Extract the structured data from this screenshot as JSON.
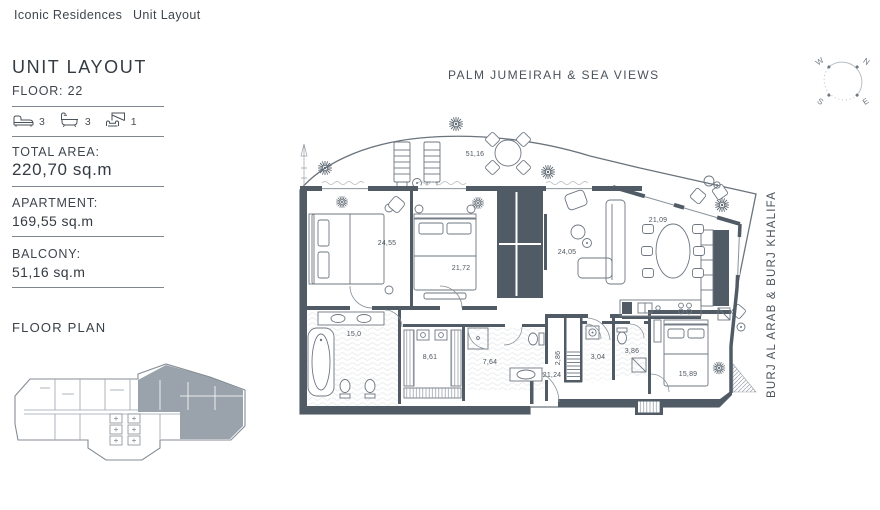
{
  "nav": {
    "brand": "Iconic Residences",
    "page": "Unit Layout"
  },
  "sidebar": {
    "title": "UNIT LAYOUT",
    "floor_label": "FLOOR: 22",
    "features": [
      {
        "icon": "bed-icon",
        "count": "3"
      },
      {
        "icon": "bath-icon",
        "count": "3"
      },
      {
        "icon": "maid-room-icon",
        "count": "1"
      }
    ],
    "stats": [
      {
        "label": "TOTAL AREA:",
        "value": "220,70 sq.m"
      },
      {
        "label": "APARTMENT:",
        "value": "169,55 sq.m"
      },
      {
        "label": "BALCONY:",
        "value": "51,16 sq.m"
      }
    ],
    "floor_plan_title": "FLOOR PLAN"
  },
  "plan": {
    "view_labels": {
      "top": "PALM JUMEIRAH & SEA VIEWS",
      "right": "BURJ AL ARAB & BURJ KHALIFA"
    },
    "compass": {
      "n": "N",
      "e": "E",
      "s": "S",
      "w": "W"
    },
    "areas": {
      "balcony": "51,16",
      "bedroom_1": "24,55",
      "bedroom_2": "21,72",
      "living": "24,05",
      "dining": "21,09",
      "master_bath": "15,0",
      "dressing": "8,61",
      "bath_2": "7,64",
      "duct": "2,86",
      "laundry": "3,04",
      "bath_3": "3,86",
      "hallway": "21,24",
      "bedroom_3": "15,89"
    }
  },
  "colors": {
    "wall": "#505b66",
    "line": "#77818b",
    "highlight": "#9aa3ab",
    "text": "#3d444b"
  }
}
